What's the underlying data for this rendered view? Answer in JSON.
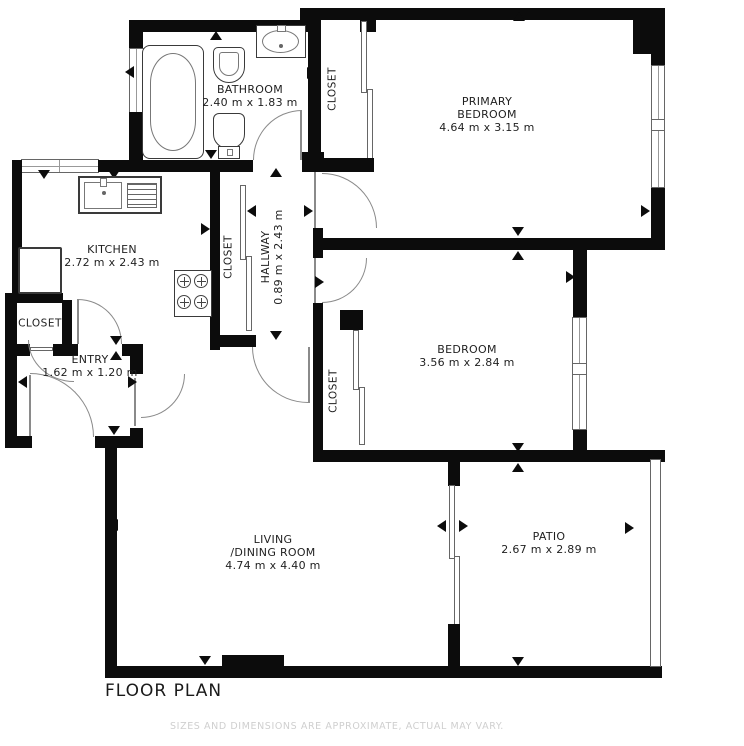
{
  "title": "FLOOR PLAN",
  "disclaimer": "SIZES AND DIMENSIONS ARE APPROXIMATE, ACTUAL MAY VARY.",
  "colors": {
    "wall": "#0c0c0c",
    "label_text": "#1f1f1f",
    "disclaimer_text": "#cfcfcf",
    "fixture_line": "#3a3a3a",
    "door_arc": "#8a8a8a",
    "background": "#ffffff"
  },
  "rooms": {
    "bathroom": {
      "name": "BATHROOM",
      "dims": "2.40 m x 1.83 m"
    },
    "primary_bedroom": {
      "line1": "PRIMARY",
      "line2": "BEDROOM",
      "dims": "4.64 m x 3.15 m"
    },
    "kitchen": {
      "name": "KITCHEN",
      "dims": "2.72 m x 2.43 m"
    },
    "hallway": {
      "name": "HALLWAY",
      "dims": "0.89 m x 2.43 m"
    },
    "entry": {
      "name": "ENTRY",
      "dims": "1.62 m x 1.20 m"
    },
    "bedroom": {
      "name": "BEDROOM",
      "dims": "3.56 m x 2.84 m"
    },
    "living_dining": {
      "line1": "LIVING",
      "line2": "/DINING ROOM",
      "dims": "4.74 m x 4.40 m"
    },
    "patio": {
      "name": "PATIO",
      "dims": "2.67 m x 2.89 m"
    }
  },
  "closets": {
    "primary_closet": {
      "label": "CLOSET"
    },
    "hall_closet": {
      "label": "CLOSET"
    },
    "entry_closet": {
      "label": "CLOSET"
    },
    "bedroom_closet": {
      "label": "CLOSET"
    }
  },
  "fixtures": {
    "bathtub": "bathtub-icon",
    "bidet": "bidet-icon",
    "toilet": "toilet-icon",
    "bathroom_sink": "sink-icon",
    "kitchen_sink": "kitchen-sink-icon",
    "stove": "stove-icon",
    "refrigerator": "refrigerator-icon"
  }
}
